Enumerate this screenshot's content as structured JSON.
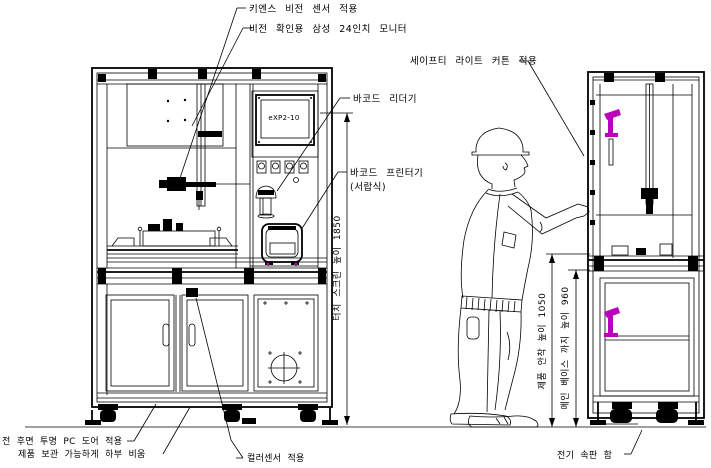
{
  "colors": {
    "line": "#000000",
    "accent": "#bb00bb",
    "background": "#ffffff"
  },
  "front_view": {
    "screen_label": "eXP2-10"
  },
  "callouts": {
    "vision_sensor": "키엔스 비전 센서 적용",
    "vision_monitor": "비전 확인용 삼성 24인치 모니터",
    "barcode_reader": "바코드 리더기",
    "barcode_printer": "바코드 프린터기",
    "barcode_printer_sub": "(서랍식)",
    "safety_light_curtain": "세이프티 라이트 커튼 적용",
    "transparent_door": "전 후면 투명 PC 도어 적용",
    "bottom_storage": "제품 보관 가능하게 하부 비움",
    "color_sensor": "컬러센서 적용",
    "electric_panel_box": "전기 속판 함"
  },
  "dimensions": {
    "touch_screen_height": "터치 스크린 높이 1850",
    "product_seating_height": "제품 안착 높이 1050",
    "main_base_height": "메인 베이스 까지 높이 960"
  }
}
